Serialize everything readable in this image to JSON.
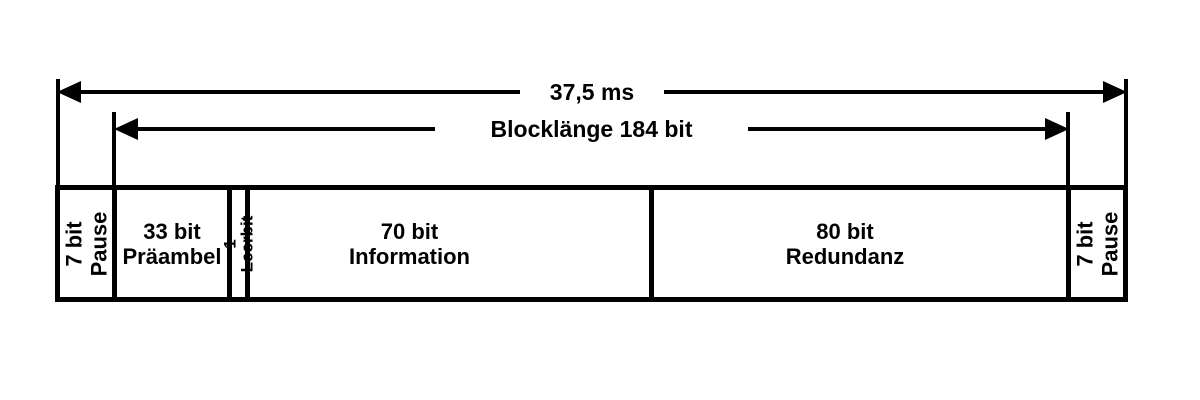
{
  "diagram": {
    "background": "#ffffff",
    "foreground": "#000000",
    "total_duration": {
      "label": "37,5 ms"
    },
    "block_length": {
      "label": "Blocklänge 184 bit"
    },
    "segments": [
      {
        "label": "7 bit\nPause"
      },
      {
        "label": "33 bit\nPräambel"
      },
      {
        "label": "1 Leerbit"
      },
      {
        "label": "70 bit\nInformation"
      },
      {
        "label": "80 bit\nRedundanz"
      },
      {
        "label": "7 bit\nPause"
      }
    ]
  }
}
